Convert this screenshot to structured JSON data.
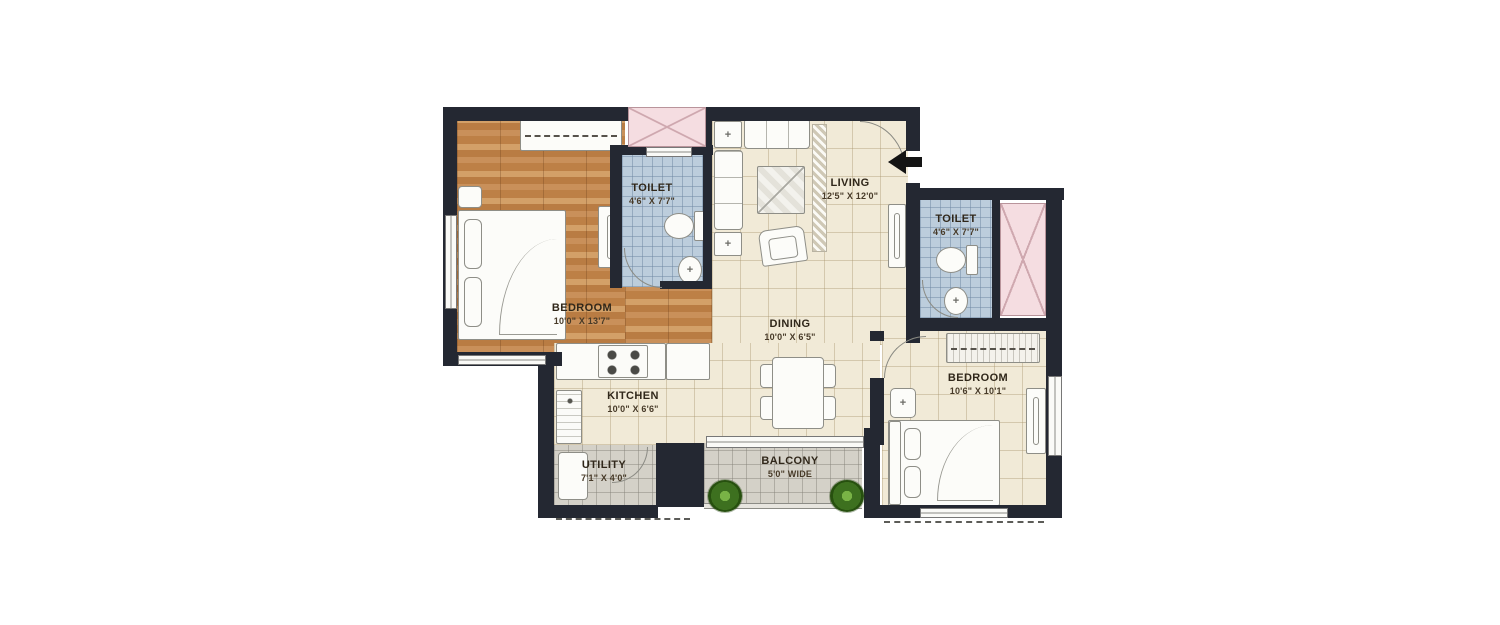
{
  "rooms": {
    "bedroom1": {
      "label": "BEDROOM",
      "dims": "10'0\" X 13'7\""
    },
    "toilet1": {
      "label": "TOILET",
      "dims": "4'6\" X 7'7\""
    },
    "living": {
      "label": "LIVING",
      "dims": "12'5\" X 12'0\""
    },
    "toilet2": {
      "label": "TOILET",
      "dims": "4'6\" X 7'7\""
    },
    "bedroom2": {
      "label": "BEDROOM",
      "dims": "10'6\" X 10'1\""
    },
    "dining": {
      "label": "DINING",
      "dims": "10'0\" X 6'5\""
    },
    "kitchen": {
      "label": "KITCHEN",
      "dims": "10'0\" X 6'6\""
    },
    "utility": {
      "label": "UTILITY",
      "dims": "7'1\" X 4'0\""
    },
    "balcony": {
      "label": "BALCONY",
      "dims": "5'0\" WIDE"
    }
  },
  "icons": {
    "basin_cross": "+"
  },
  "colors": {
    "wall": "#242832",
    "wood_floor": "#c08a52",
    "cream_floor": "#f1ead7",
    "toilet_tile": "#bccddc",
    "balcony_tile": "#d4d1c8",
    "duct_pink": "#f5dde1",
    "plant_green": "#3d701f"
  }
}
